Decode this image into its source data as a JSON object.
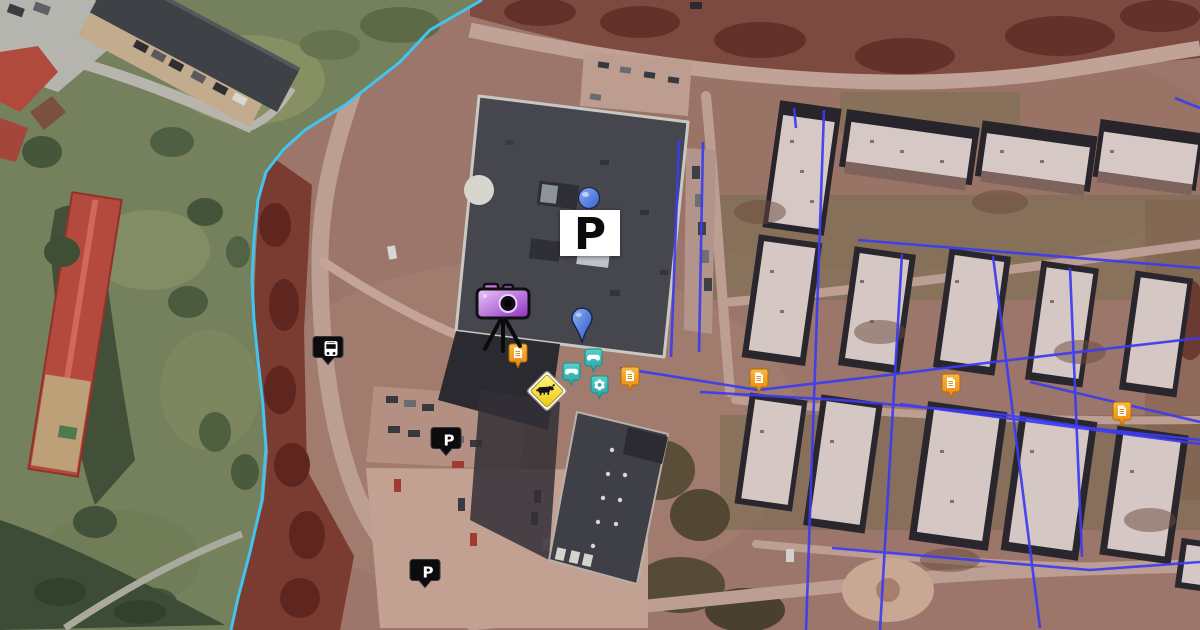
{
  "map": {
    "view": "aerial",
    "parking_label": "P"
  },
  "colors": {
    "boundary_line": "#41c4ee",
    "route_lines": "#3c3cf0",
    "note_marker_orange": "#f0941c",
    "poi_marker_teal": "#35b9b4",
    "pin_blue": "#3f68d6",
    "balloon_blue": "#5c8ae8",
    "warning_sign_yellow": "#f2d51c",
    "transit_marker_black": "#0d0d0f",
    "camera_purple": "#a74fd0",
    "tint_overlay_red": "#8a4a3e"
  },
  "markers": [
    {
      "kind": "parking-sign",
      "label": "P",
      "x": 560,
      "y": 185
    },
    {
      "kind": "camera",
      "x": 472,
      "y": 283
    },
    {
      "kind": "pin",
      "x": 571,
      "y": 307
    },
    {
      "kind": "bus-stop",
      "x": 318,
      "y": 335
    },
    {
      "kind": "parking-black",
      "label": "P",
      "x": 436,
      "y": 426
    },
    {
      "kind": "parking-black",
      "label": "P",
      "x": 415,
      "y": 558
    },
    {
      "kind": "note",
      "x": 508,
      "y": 343
    },
    {
      "kind": "note",
      "x": 620,
      "y": 366
    },
    {
      "kind": "note",
      "x": 749,
      "y": 368
    },
    {
      "kind": "note",
      "x": 941,
      "y": 373
    },
    {
      "kind": "note",
      "x": 1112,
      "y": 401
    },
    {
      "kind": "warning",
      "glyph": "cow",
      "x": 525,
      "y": 369
    },
    {
      "kind": "poi",
      "glyph": "game-controller",
      "x": 584,
      "y": 348
    },
    {
      "kind": "poi",
      "glyph": "game-controller",
      "x": 562,
      "y": 362
    },
    {
      "kind": "poi",
      "glyph": "flower",
      "x": 590,
      "y": 375
    }
  ]
}
